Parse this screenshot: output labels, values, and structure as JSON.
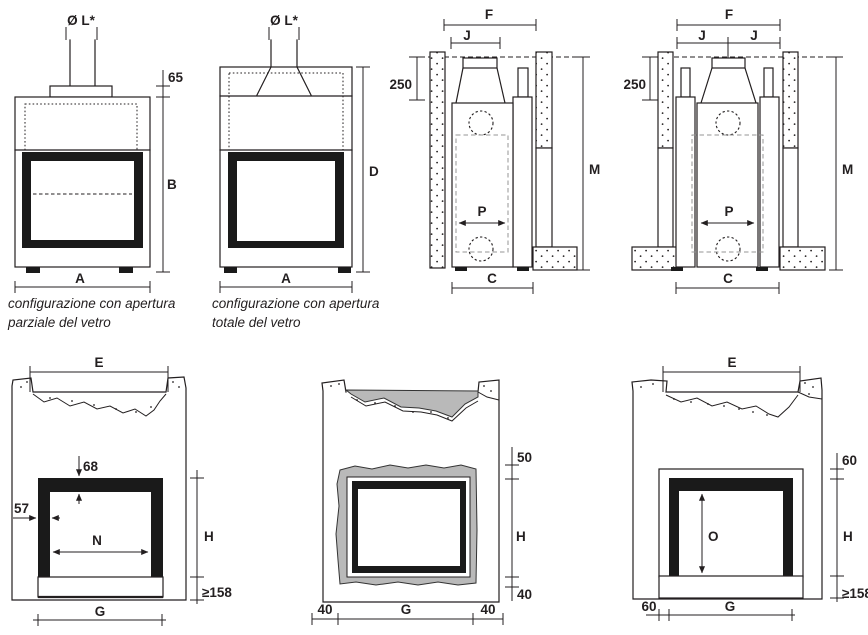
{
  "figure": {
    "background": "#ffffff",
    "line_color": "#231f20",
    "gray_fill": "#b9b9b9",
    "frame_color": "#1a1a1a"
  },
  "top_row": {
    "partial": {
      "flue_diameter": "Ø L*",
      "collar_height": "65",
      "body_height": "B",
      "body_width": "A",
      "caption_line1": "configurazione con apertura",
      "caption_line2": "parziale del vetro"
    },
    "total": {
      "flue_diameter": "Ø L*",
      "body_height": "D",
      "body_width": "A",
      "caption_line1": "configurazione con apertura",
      "caption_line2": "totale del vetro"
    },
    "section_single": {
      "niche_width": "F",
      "flue_offset": "J",
      "top_clearance": "250",
      "depth": "P",
      "total_height": "M",
      "base_depth": "C"
    },
    "section_double": {
      "niche_width": "F",
      "flue_offset_left": "J",
      "flue_offset_right": "J",
      "top_clearance": "250",
      "depth": "P",
      "total_height": "M",
      "base_depth": "C"
    }
  },
  "bottom_row": {
    "front_finished": {
      "niche_width": "E",
      "frame_top_overlap": "68",
      "frame_side_overlap": "57",
      "opening_width": "N",
      "opening_height": "H",
      "hearth_min_height": "≥158",
      "base_width": "G"
    },
    "front_counterhood": {
      "top_gap": "50",
      "opening_height": "H",
      "bottom_gap": "40",
      "left_margin": "40",
      "base_width": "G",
      "right_margin": "40"
    },
    "front_glass": {
      "niche_width": "E",
      "top_gap": "60",
      "glass_height": "O",
      "opening_height": "H",
      "hearth_min_height": "≥158",
      "left_margin": "60",
      "base_width": "G"
    }
  }
}
